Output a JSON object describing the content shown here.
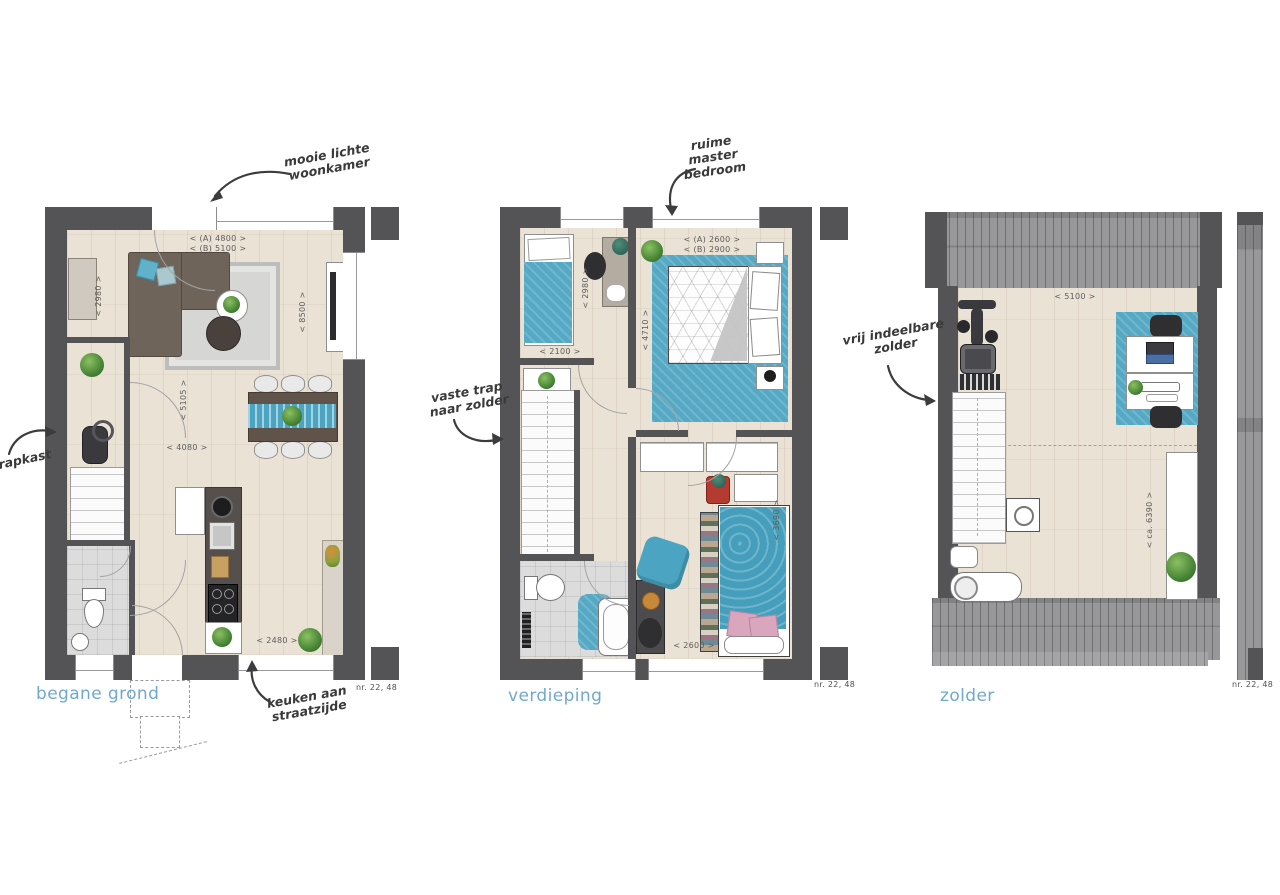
{
  "colors": {
    "wall": "#545456",
    "floor_wood": "#eae2d5",
    "label_blue": "#6fa9cc",
    "textile_teal": "#4ba5c2",
    "annotation_ink": "#3a3a3a"
  },
  "plans": {
    "ground": {
      "label": "begane grond",
      "nr": "nr. 22, 48",
      "annotations": {
        "woonkamer": "mooie lichte\nwoonkamer",
        "trapkast": "trapkast",
        "keuken": "keuken aan\nstraatzijde"
      },
      "dims": {
        "a_width": "<  (A) 4800  >",
        "b_width": "<  (B) 5100  >",
        "depth": "<  8500  >",
        "left": "<  2980  >",
        "hall": "<  5105  >",
        "mid": "<  4080  >",
        "kitchen": "<  2480  >"
      }
    },
    "first": {
      "label": "verdieping",
      "nr": "nr. 22, 48",
      "annotations": {
        "master": "ruime\nmaster\nbedroom",
        "trap": "vaste trap\nnaar zolder"
      },
      "dims": {
        "a_width": "<  (A) 2600  >",
        "b_width": "<  (B) 2900  >",
        "room1_depth": "<  2980  >",
        "room1_width": "<  2100  >",
        "master_depth": "<  4710  >",
        "room2_depth": "<  3690  >",
        "room2_width": "<  2600  >"
      }
    },
    "attic": {
      "label": "zolder",
      "nr": "nr. 22, 48",
      "annotations": {
        "zolder": "vrij indeelbare\nzolder"
      },
      "dims": {
        "width": "<  5100  >",
        "depth": "<  ca. 6390  >"
      }
    }
  }
}
